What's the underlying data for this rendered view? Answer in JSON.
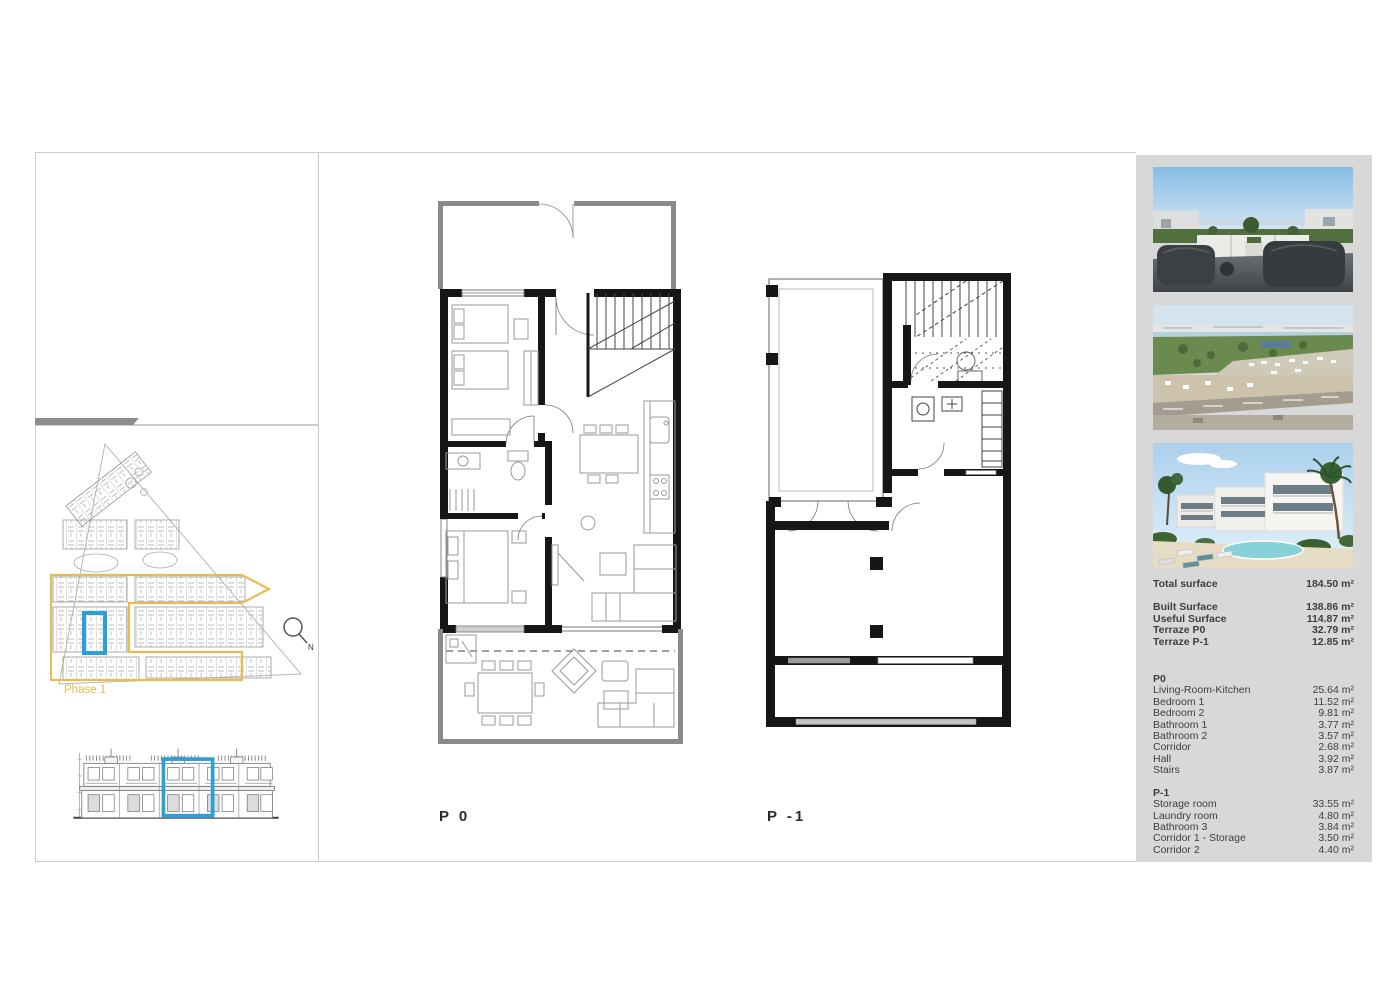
{
  "colors": {
    "accent_blue": "#2B9FD8",
    "phase_yellow": "#E9BC52",
    "sidebar_bg": "#D8D8D8",
    "panel_border": "#CCCCCC",
    "divider_bar_gray": "#8C8C8C",
    "wall_black": "#161616",
    "terrace_wall_gray": "#8A8A8A"
  },
  "site_panel": {
    "phase_label": "Phase 1",
    "compass_label": "N"
  },
  "plan_labels": {
    "p0": "P 0",
    "p1": "P -1"
  },
  "sidebar": {
    "photos": [
      {
        "name": "terrace-sea-view-render"
      },
      {
        "name": "aerial-coastline-view"
      },
      {
        "name": "residential-complex-pool-render"
      }
    ],
    "summary": {
      "total": {
        "label": "Total surface",
        "value": "184.50 m²"
      },
      "rows": [
        {
          "label": "Built Surface",
          "value": "138.86 m²"
        },
        {
          "label": "Useful Surface",
          "value": "114.87 m²"
        },
        {
          "label": "Terraze P0",
          "value": "32.79 m²"
        },
        {
          "label": "Terraze P-1",
          "value": "12.85 m²"
        }
      ]
    },
    "p0": {
      "title": "P0",
      "rows": [
        {
          "label": "Living-Room-Kitchen",
          "value": "25.64 m²"
        },
        {
          "label": "Bedroom 1",
          "value": "11.52 m²"
        },
        {
          "label": "Bedroom 2",
          "value": "9.81 m²"
        },
        {
          "label": "Bathroom 1",
          "value": "3.77 m²"
        },
        {
          "label": "Bathroom 2",
          "value": "3.57 m²"
        },
        {
          "label": "Corridor",
          "value": "2.68 m²"
        },
        {
          "label": "Hall",
          "value": "3.92 m²"
        },
        {
          "label": "Stairs",
          "value": "3.87 m²"
        }
      ]
    },
    "p1": {
      "title": "P-1",
      "rows": [
        {
          "label": "Storage room",
          "value": "33.55 m²"
        },
        {
          "label": "Laundry room",
          "value": "4.80 m²"
        },
        {
          "label": "Bathroom 3",
          "value": "3.84 m²"
        },
        {
          "label": "Corridor 1 - Storage",
          "value": "3.50 m²"
        },
        {
          "label": "Corridor 2",
          "value": "4.40 m²"
        }
      ]
    }
  }
}
